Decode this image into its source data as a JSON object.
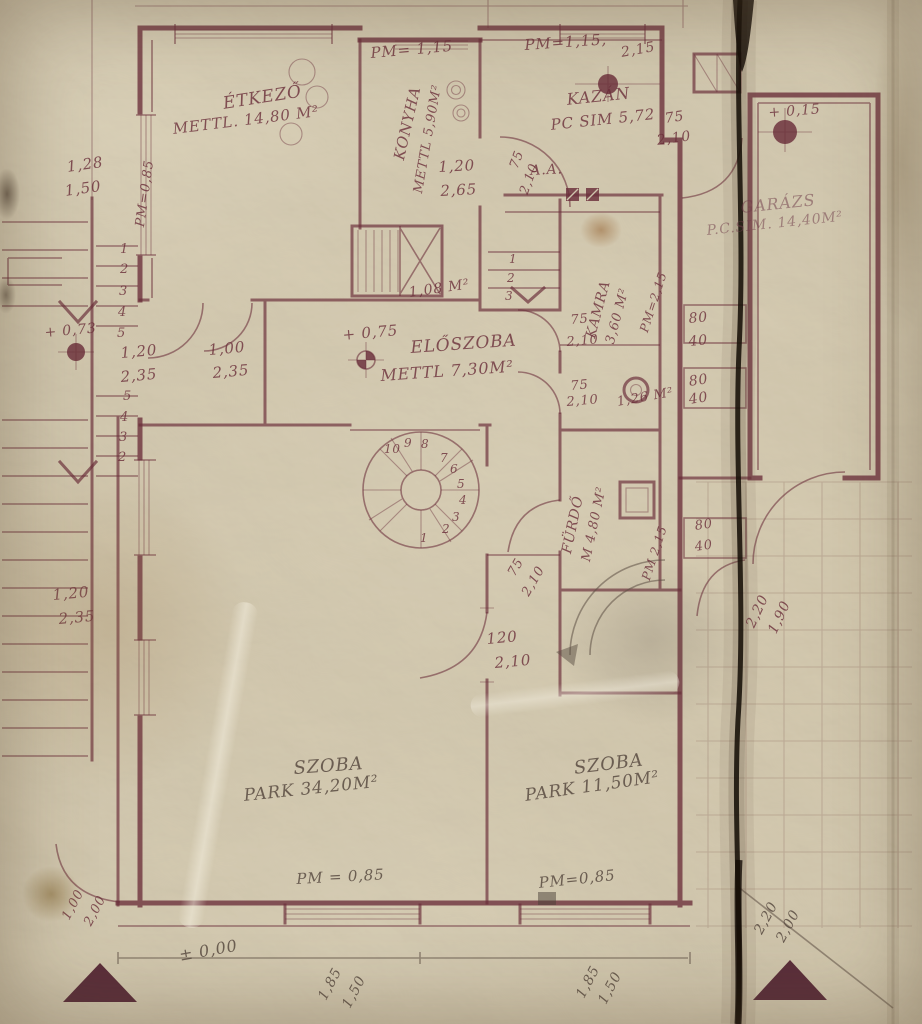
{
  "colors": {
    "ink": "#6a2e3a",
    "pencil": "#5c4f44",
    "fold": "#171008",
    "triangle": "#4f2130",
    "paper": "#c9bfa7"
  },
  "plan": {
    "labels": [
      {
        "n": "pm-konyha-top",
        "t": "PM= 1,15",
        "x": 370,
        "y": 46,
        "r": -5,
        "s": 15,
        "c": "ink"
      },
      {
        "n": "pm-kazan-top",
        "t": "PM=1,15,",
        "x": 524,
        "y": 38,
        "r": -4,
        "s": 15,
        "c": "ink"
      },
      {
        "n": "dim-kazan-top",
        "t": "2,15",
        "x": 620,
        "y": 46,
        "r": -10,
        "s": 14,
        "c": "ink"
      },
      {
        "n": "room-etkezo-name",
        "t": "ÉTKEZŐ",
        "x": 222,
        "y": 96,
        "r": -9,
        "s": 17,
        "c": "ink"
      },
      {
        "n": "room-etkezo-area",
        "t": "METTL. 14,80 M²",
        "x": 172,
        "y": 122,
        "r": -7,
        "s": 15,
        "c": "ink"
      },
      {
        "n": "room-konyha-name",
        "t": "KONYHA",
        "x": 392,
        "y": 158,
        "r": -77,
        "s": 15,
        "c": "ink"
      },
      {
        "n": "room-konyha-area",
        "t": "METTL 5,90M²",
        "x": 412,
        "y": 192,
        "r": -80,
        "s": 13,
        "c": "ink"
      },
      {
        "n": "room-kazan-name",
        "t": "KAZÁN",
        "x": 566,
        "y": 92,
        "r": -6,
        "s": 16,
        "c": "ink"
      },
      {
        "n": "room-kazan-area",
        "t": "PC SIM 5,72",
        "x": 550,
        "y": 118,
        "r": -6,
        "s": 15,
        "c": "ink"
      },
      {
        "n": "dim-garagedoor-n-w",
        "t": "75",
        "x": 664,
        "y": 112,
        "r": -8,
        "s": 14,
        "c": "ink"
      },
      {
        "n": "dim-garagedoor-n-h",
        "t": "2,10",
        "x": 656,
        "y": 134,
        "r": -8,
        "s": 14,
        "c": "ink"
      },
      {
        "n": "level-garage",
        "t": "+ 0,15",
        "x": 768,
        "y": 106,
        "r": -4,
        "s": 14,
        "c": "ink"
      },
      {
        "n": "room-garaz-name",
        "t": "GARÁZS",
        "x": 740,
        "y": 200,
        "r": -6,
        "s": 16,
        "c": "ink2"
      },
      {
        "n": "room-garaz-area",
        "t": "P.C.SIM. 14,40M²",
        "x": 706,
        "y": 224,
        "r": -6,
        "s": 14,
        "c": "ink2"
      },
      {
        "n": "dim-left-top-a",
        "t": "1,28",
        "x": 66,
        "y": 160,
        "r": -8,
        "s": 15,
        "c": "ink"
      },
      {
        "n": "dim-left-top-b",
        "t": "1,50",
        "x": 64,
        "y": 184,
        "r": -8,
        "s": 15,
        "c": "ink"
      },
      {
        "n": "pm-etkezo-window",
        "t": "PM=0,85",
        "x": 134,
        "y": 226,
        "r": -82,
        "s": 13,
        "c": "ink"
      },
      {
        "n": "dim-konyha-a",
        "t": "1,20",
        "x": 438,
        "y": 160,
        "r": -3,
        "s": 15,
        "c": "ink"
      },
      {
        "n": "dim-konyha-b",
        "t": "2,65",
        "x": 440,
        "y": 184,
        "r": -3,
        "s": 15,
        "c": "ink"
      },
      {
        "n": "dim-halldoor-w",
        "t": "75",
        "x": 508,
        "y": 166,
        "r": -70,
        "s": 13,
        "c": "ink"
      },
      {
        "n": "dim-halldoor-h",
        "t": "2,10",
        "x": 518,
        "y": 192,
        "r": -70,
        "s": 13,
        "c": "ink"
      },
      {
        "n": "section-aa",
        "t": "A.A.",
        "x": 530,
        "y": 164,
        "r": -3,
        "s": 14,
        "c": "ink"
      },
      {
        "n": "room-kamra-name",
        "t": "KAMRA",
        "x": 584,
        "y": 336,
        "r": -75,
        "s": 14,
        "c": "ink"
      },
      {
        "n": "room-kamra-area",
        "t": "3,60 M²",
        "x": 604,
        "y": 342,
        "r": -75,
        "s": 13,
        "c": "ink"
      },
      {
        "n": "pm-kamra",
        "t": "PM=2,15",
        "x": 638,
        "y": 330,
        "r": -72,
        "s": 12,
        "c": "ink"
      },
      {
        "n": "dim-kamradoor1-w",
        "t": "75",
        "x": 570,
        "y": 314,
        "r": -5,
        "s": 13,
        "c": "ink"
      },
      {
        "n": "dim-kamradoor1-h",
        "t": "2,10",
        "x": 566,
        "y": 336,
        "r": -5,
        "s": 13,
        "c": "ink"
      },
      {
        "n": "dim-kamradoor2-w",
        "t": "75",
        "x": 570,
        "y": 380,
        "r": -5,
        "s": 13,
        "c": "ink"
      },
      {
        "n": "dim-kamradoor2-h",
        "t": "2,10",
        "x": 566,
        "y": 396,
        "r": -5,
        "s": 13,
        "c": "ink"
      },
      {
        "n": "dim-shelf1-a",
        "t": "80",
        "x": 688,
        "y": 312,
        "r": -5,
        "s": 14,
        "c": "ink"
      },
      {
        "n": "dim-shelf1-b",
        "t": "40",
        "x": 688,
        "y": 335,
        "r": -5,
        "s": 14,
        "c": "ink"
      },
      {
        "n": "dim-shelf2-a",
        "t": "80",
        "x": 688,
        "y": 375,
        "r": -8,
        "s": 14,
        "c": "ink"
      },
      {
        "n": "dim-shelf2-b",
        "t": "40",
        "x": 688,
        "y": 393,
        "r": -8,
        "s": 14,
        "c": "ink"
      },
      {
        "n": "area-wc",
        "t": "1,26 M²",
        "x": 616,
        "y": 396,
        "r": -10,
        "s": 13,
        "c": "ink"
      },
      {
        "n": "level-terrace",
        "t": "+ 0,73",
        "x": 44,
        "y": 326,
        "r": -5,
        "s": 14,
        "c": "ink"
      },
      {
        "n": "dim-door-etk1-w",
        "t": "1,20",
        "x": 120,
        "y": 346,
        "r": -5,
        "s": 15,
        "c": "ink"
      },
      {
        "n": "dim-door-etk1-h",
        "t": "2,35",
        "x": 120,
        "y": 370,
        "r": -5,
        "s": 15,
        "c": "ink"
      },
      {
        "n": "dim-door-etk2-w",
        "t": "1,00",
        "x": 208,
        "y": 343,
        "r": -5,
        "s": 15,
        "c": "ink"
      },
      {
        "n": "dim-door-etk2-h",
        "t": "2,35",
        "x": 212,
        "y": 366,
        "r": -5,
        "s": 15,
        "c": "ink"
      },
      {
        "n": "level-eloszoba",
        "t": "+ 0,75",
        "x": 342,
        "y": 328,
        "r": -5,
        "s": 15,
        "c": "ink"
      },
      {
        "n": "room-eloszoba-name",
        "t": "ELŐSZOBA",
        "x": 410,
        "y": 340,
        "r": -4,
        "s": 17,
        "c": "ink"
      },
      {
        "n": "room-eloszoba-area",
        "t": "METTL 7,30M²",
        "x": 380,
        "y": 368,
        "r": -4,
        "s": 16,
        "c": "ink"
      },
      {
        "n": "area-stairhall",
        "t": "1,08 M²",
        "x": 408,
        "y": 286,
        "r": -8,
        "s": 14,
        "c": "ink"
      },
      {
        "n": "stair-f1-1",
        "t": "1",
        "x": 120,
        "y": 243,
        "r": 0,
        "s": 13,
        "c": "ink"
      },
      {
        "n": "stair-f1-2",
        "t": "2",
        "x": 120,
        "y": 263,
        "r": 0,
        "s": 13,
        "c": "ink"
      },
      {
        "n": "stair-f1-3",
        "t": "3",
        "x": 119,
        "y": 285,
        "r": 0,
        "s": 13,
        "c": "ink"
      },
      {
        "n": "stair-f1-4",
        "t": "4",
        "x": 118,
        "y": 306,
        "r": 0,
        "s": 13,
        "c": "ink"
      },
      {
        "n": "stair-f1-5",
        "t": "5",
        "x": 117,
        "y": 327,
        "r": 0,
        "s": 13,
        "c": "ink"
      },
      {
        "n": "stair-f2-5",
        "t": "5",
        "x": 123,
        "y": 390,
        "r": 0,
        "s": 13,
        "c": "ink"
      },
      {
        "n": "stair-f2-4",
        "t": "4",
        "x": 120,
        "y": 411,
        "r": 0,
        "s": 13,
        "c": "ink"
      },
      {
        "n": "stair-f2-3",
        "t": "3",
        "x": 119,
        "y": 431,
        "r": 0,
        "s": 13,
        "c": "ink"
      },
      {
        "n": "stair-f2-2",
        "t": "2",
        "x": 118,
        "y": 451,
        "r": 0,
        "s": 13,
        "c": "ink"
      },
      {
        "n": "stair-kazan-1",
        "t": "1",
        "x": 509,
        "y": 253,
        "r": 0,
        "s": 12,
        "c": "ink"
      },
      {
        "n": "stair-kazan-2",
        "t": "2",
        "x": 507,
        "y": 272,
        "r": 0,
        "s": 12,
        "c": "ink"
      },
      {
        "n": "stair-kazan-3",
        "t": "3",
        "x": 505,
        "y": 290,
        "r": 0,
        "s": 12,
        "c": "ink"
      },
      {
        "n": "spiral-1",
        "t": "1",
        "x": 420,
        "y": 532,
        "r": 0,
        "s": 12,
        "c": "ink"
      },
      {
        "n": "spiral-2",
        "t": "2",
        "x": 442,
        "y": 523,
        "r": 0,
        "s": 12,
        "c": "ink"
      },
      {
        "n": "spiral-3",
        "t": "3",
        "x": 452,
        "y": 511,
        "r": 0,
        "s": 12,
        "c": "ink"
      },
      {
        "n": "spiral-4",
        "t": "4",
        "x": 459,
        "y": 494,
        "r": 0,
        "s": 12,
        "c": "ink"
      },
      {
        "n": "spiral-5",
        "t": "5",
        "x": 457,
        "y": 478,
        "r": 0,
        "s": 12,
        "c": "ink"
      },
      {
        "n": "spiral-6",
        "t": "6",
        "x": 450,
        "y": 463,
        "r": 0,
        "s": 12,
        "c": "ink"
      },
      {
        "n": "spiral-7",
        "t": "7",
        "x": 440,
        "y": 452,
        "r": 0,
        "s": 12,
        "c": "ink"
      },
      {
        "n": "spiral-8",
        "t": "8",
        "x": 421,
        "y": 438,
        "r": 0,
        "s": 12,
        "c": "ink"
      },
      {
        "n": "spiral-9",
        "t": "9",
        "x": 404,
        "y": 437,
        "r": 0,
        "s": 12,
        "c": "ink"
      },
      {
        "n": "spiral-10",
        "t": "10",
        "x": 384,
        "y": 443,
        "r": 0,
        "s": 12,
        "c": "ink"
      },
      {
        "n": "dim-furdodoor-w",
        "t": "75",
        "x": 506,
        "y": 572,
        "r": -60,
        "s": 13,
        "c": "ink"
      },
      {
        "n": "dim-furdodoor-h",
        "t": "2,10",
        "x": 520,
        "y": 592,
        "r": -60,
        "s": 13,
        "c": "ink"
      },
      {
        "n": "room-furdo-name",
        "t": "FÜRDŐ",
        "x": 560,
        "y": 552,
        "r": -78,
        "s": 14,
        "c": "ink"
      },
      {
        "n": "room-furdo-area",
        "t": "M 4,80 M²",
        "x": 580,
        "y": 560,
        "r": -78,
        "s": 13,
        "c": "ink"
      },
      {
        "n": "pm-furdo",
        "t": "PM 2,15",
        "x": 640,
        "y": 578,
        "r": -72,
        "s": 12,
        "c": "ink"
      },
      {
        "n": "dim-shelf3-a",
        "t": "80",
        "x": 694,
        "y": 520,
        "r": -8,
        "s": 13,
        "c": "ink"
      },
      {
        "n": "dim-shelf3-b",
        "t": "40",
        "x": 694,
        "y": 541,
        "r": -8,
        "s": 13,
        "c": "ink"
      },
      {
        "n": "dim-szobadoor-w",
        "t": "120",
        "x": 486,
        "y": 632,
        "r": -5,
        "s": 15,
        "c": "ink"
      },
      {
        "n": "dim-szobadoor-h",
        "t": "2,10",
        "x": 494,
        "y": 656,
        "r": -5,
        "s": 15,
        "c": "ink"
      },
      {
        "n": "dim-leftdoor-w",
        "t": "1,20",
        "x": 52,
        "y": 588,
        "r": -5,
        "s": 15,
        "c": "ink"
      },
      {
        "n": "dim-leftdoor-h",
        "t": "2,35",
        "x": 58,
        "y": 612,
        "r": -5,
        "s": 15,
        "c": "ink"
      },
      {
        "n": "room-szoba1-name",
        "t": "SZOBA",
        "x": 293,
        "y": 760,
        "r": -4,
        "s": 18,
        "c": "pencil"
      },
      {
        "n": "room-szoba1-area",
        "t": "PARK 34,20M²",
        "x": 243,
        "y": 788,
        "r": -6,
        "s": 17,
        "c": "pencil"
      },
      {
        "n": "room-szoba2-name",
        "t": "SZOBA",
        "x": 573,
        "y": 760,
        "r": -7,
        "s": 18,
        "c": "pencil"
      },
      {
        "n": "room-szoba2-area",
        "t": "PARK 11,50M²",
        "x": 524,
        "y": 788,
        "r": -8,
        "s": 17,
        "c": "pencil"
      },
      {
        "n": "pm-szoba1",
        "t": "PM = 0,85",
        "x": 296,
        "y": 872,
        "r": -3,
        "s": 15,
        "c": "pencil"
      },
      {
        "n": "pm-szoba2",
        "t": "PM=0,85",
        "x": 538,
        "y": 876,
        "r": -6,
        "s": 15,
        "c": "pencil"
      },
      {
        "n": "dim-win1-a",
        "t": "1,85",
        "x": 316,
        "y": 996,
        "r": -62,
        "s": 14,
        "c": "pencil"
      },
      {
        "n": "dim-win1-b",
        "t": "1,50",
        "x": 340,
        "y": 1004,
        "r": -62,
        "s": 14,
        "c": "pencil"
      },
      {
        "n": "dim-win2-a",
        "t": "1,85",
        "x": 574,
        "y": 994,
        "r": -62,
        "s": 14,
        "c": "pencil"
      },
      {
        "n": "dim-win2-b",
        "t": "1,50",
        "x": 596,
        "y": 1000,
        "r": -62,
        "s": 14,
        "c": "pencil"
      },
      {
        "n": "level-zero",
        "t": "± 0,00",
        "x": 178,
        "y": 948,
        "r": -10,
        "s": 16,
        "c": "pencil"
      },
      {
        "n": "dim-extdoor-a",
        "t": "1,00",
        "x": 60,
        "y": 916,
        "r": -62,
        "s": 13,
        "c": "ink"
      },
      {
        "n": "dim-extdoor-b",
        "t": "2,00",
        "x": 82,
        "y": 922,
        "r": -62,
        "s": 13,
        "c": "ink"
      },
      {
        "n": "dim-garagedoor-a",
        "t": "2,20",
        "x": 744,
        "y": 624,
        "r": -65,
        "s": 14,
        "c": "ink"
      },
      {
        "n": "dim-garagedoor-b",
        "t": "1,90",
        "x": 766,
        "y": 630,
        "r": -65,
        "s": 14,
        "c": "ink"
      },
      {
        "n": "dim-gate-a",
        "t": "2,20",
        "x": 752,
        "y": 930,
        "r": -62,
        "s": 14,
        "c": "pencil"
      },
      {
        "n": "dim-gate-b",
        "t": "2,00",
        "x": 774,
        "y": 938,
        "r": -62,
        "s": 14,
        "c": "pencil"
      }
    ]
  }
}
